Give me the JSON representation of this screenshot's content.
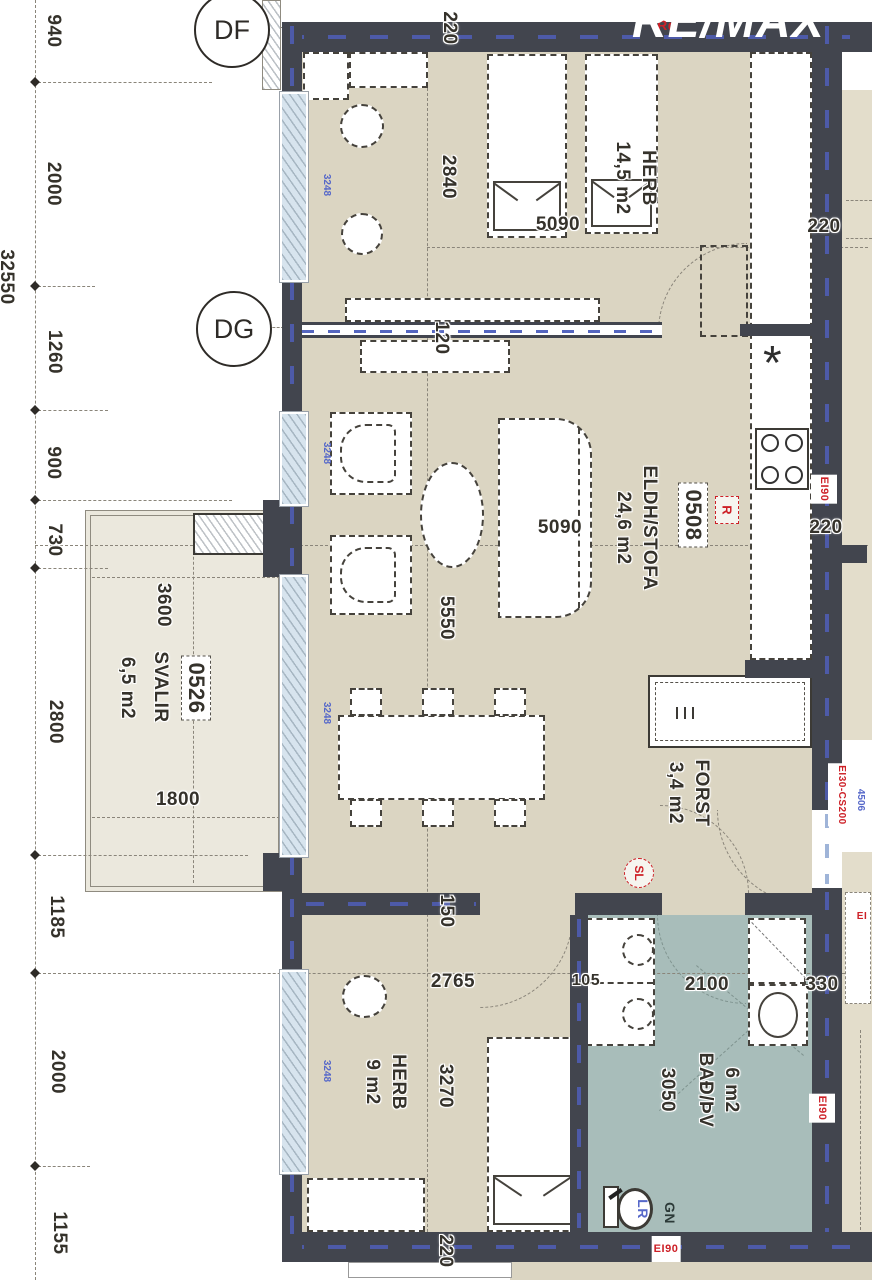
{
  "branding": {
    "logo": "RE/MAX"
  },
  "grid_markers": {
    "df": "DF",
    "dg": "DG"
  },
  "dim_chain": {
    "total": "32550",
    "seg_940": "940",
    "seg_2000a": "2000",
    "seg_1260": "1260",
    "seg_900": "900",
    "seg_730": "730",
    "seg_2800": "2800",
    "seg_1185": "1185",
    "seg_2000b": "2000",
    "seg_1155": "1155"
  },
  "rooms": {
    "herb_top": {
      "name": "HERB",
      "area": "14,5 m2"
    },
    "eldh_stofa": {
      "number": "0508",
      "name": "ELDH/STOFA",
      "area": "24,6 m2"
    },
    "svalir": {
      "number": "0526",
      "name": "SVALIR",
      "area": "6,5 m2"
    },
    "forst": {
      "name": "FORST",
      "area": "3,4 m2"
    },
    "herb_bottom": {
      "name": "HERB",
      "area": "9 m2"
    },
    "bad": {
      "name": "BAÐ/ÞV",
      "area": "6 m2"
    }
  },
  "dimensions": {
    "top_wall": "220",
    "herb_top_w": "2840",
    "herb_top_l": "5090",
    "kitchen_a": "220",
    "kitchen_b": "220",
    "partition": "120",
    "sofa": "5090",
    "dining_l": "5550",
    "dining_gap": "150",
    "svalir_w": "3600",
    "svalir_l": "1800",
    "herb2_w": "2765",
    "herb2_l": "3270",
    "bath_gap": "105",
    "bath_w": "2100",
    "bath_edge": "330",
    "bath_l": "3050",
    "bottom_wall": "220"
  },
  "fire_ratings": {
    "right_a": "EI90",
    "right_b": "EI90",
    "bottom": "EI90",
    "door": "EI30-CS200",
    "edge_partial": "EI"
  },
  "markers": {
    "r_box": "R",
    "r_top": "Rd",
    "sl": "SL",
    "gn": "GN",
    "lr": "LR"
  },
  "window_codes": {
    "w1": "3248",
    "w2": "3248",
    "w3": "3248",
    "w4": "3248",
    "door_code": "4506"
  },
  "colors": {
    "wall": "#42454e",
    "floor": "#dbd5c2",
    "bath_floor": "#a8bdba",
    "balcony": "#ebe8dd",
    "window": "#d7e4ee",
    "wall_dash": "#4d5aa8",
    "label_red": "#cd2027",
    "label_blue": "#5668c9"
  }
}
